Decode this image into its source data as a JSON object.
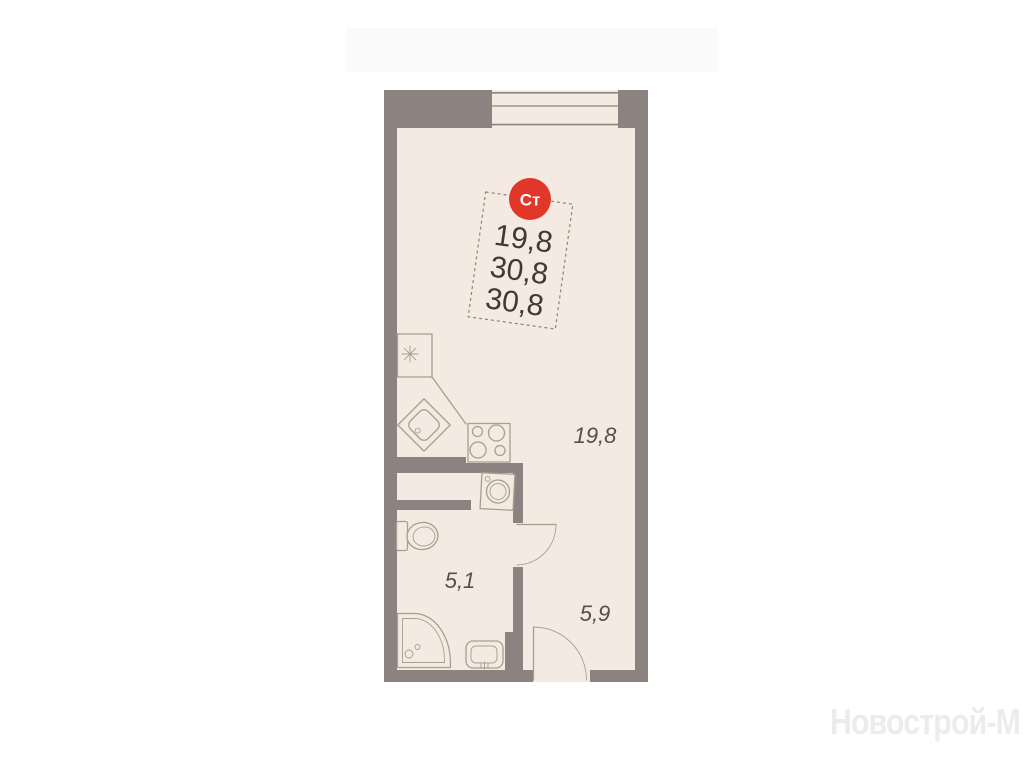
{
  "plan": {
    "unit_type_badge": "Ст",
    "area_values": [
      "19,8",
      "30,8",
      "30,8"
    ],
    "rooms": [
      {
        "id": "living-room",
        "area": "19,8"
      },
      {
        "id": "bathroom",
        "area": "5,1"
      },
      {
        "id": "hallway",
        "area": "5,9"
      }
    ]
  },
  "watermark": "Новострой-М",
  "colors": {
    "background": "#ffffff",
    "wall_gray": "#8c8380",
    "floor_cream": "#f4eae1",
    "fixture_line": "#a89d91",
    "badge_red": "#e1362a",
    "badge_text": "#ffffff",
    "area_text": "#3e3a36",
    "room_label_text": "#55504b",
    "watermark_text": "#ececec"
  }
}
